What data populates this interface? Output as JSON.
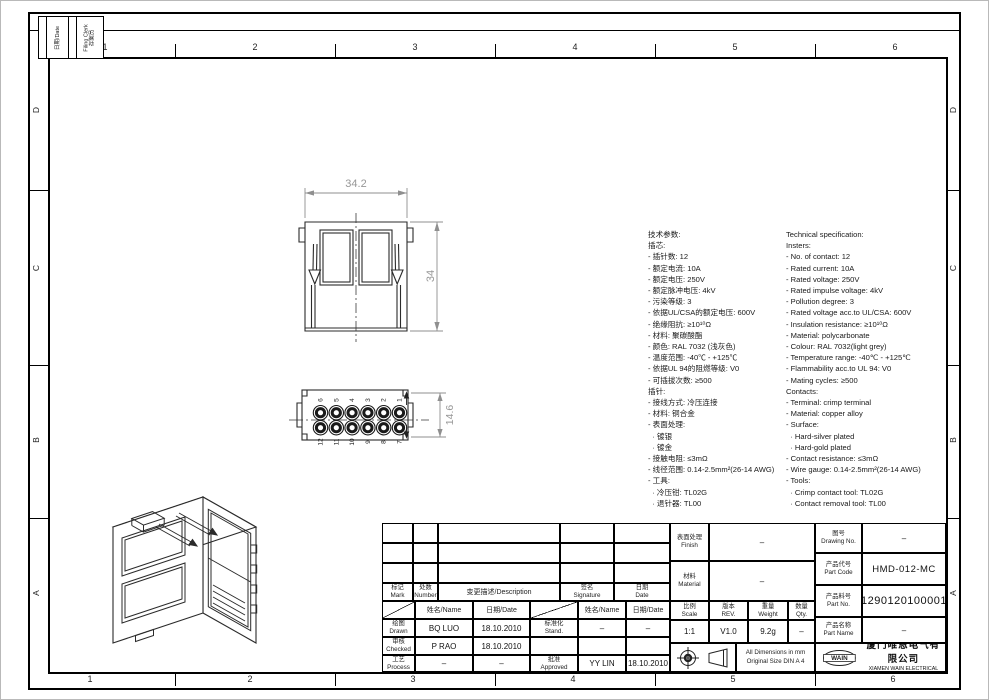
{
  "sheet": {
    "zones": {
      "top": [
        "1",
        "2",
        "3",
        "4",
        "5",
        "6"
      ],
      "bottom": [
        "1",
        "2",
        "3",
        "4",
        "5",
        "6"
      ],
      "left": [
        "D",
        "C",
        "B",
        "A"
      ],
      "right": [
        "D",
        "C",
        "B",
        "A"
      ]
    },
    "stamp": {
      "date_label": "日期/Date",
      "clerk_en": "Filing Clerk",
      "clerk_cn": "存案员"
    }
  },
  "views": {
    "front": {
      "dim_width": "34.2",
      "dim_height": "34"
    },
    "pinout": {
      "dim_height": "14.6",
      "pins_top": [
        "6",
        "5",
        "4",
        "3",
        "2",
        "1"
      ],
      "pins_bottom": [
        "12",
        "11",
        "10",
        "9",
        "8",
        "7"
      ]
    }
  },
  "specs": {
    "cn_lines": [
      "技术参数:",
      "插芯:",
      "- 插针数: 12",
      "- 额定电流: 10A",
      "- 额定电压: 250V",
      "- 额定脉冲电压: 4kV",
      "- 污染等级: 3",
      "- 依据UL/CSA的额定电压: 600V",
      "- 绝缘阻抗: ≥10¹⁰Ω",
      "- 材料: 聚碳酸酯",
      "- 颜色: RAL 7032 (浅灰色)",
      "- 温度范围: -40℃ - +125℃",
      "- 依据UL 94的阻燃等级: V0",
      "- 可插拔次数: ≥500",
      "插针:",
      "- 接线方式: 冷压连接",
      "- 材料: 铜合金",
      "- 表面处理:",
      "  · 镀银",
      "  · 镀金",
      "- 接触电阻: ≤3mΩ",
      "- 线径范围: 0.14-2.5mm²(26-14 AWG)",
      "- 工具:",
      "  · 冷压钳: TL02G",
      "  · 退针器: TL00"
    ],
    "en_lines": [
      "Technical specification:",
      "Insters:",
      "- No. of contact: 12",
      "- Rated current: 10A",
      "- Rated voltage: 250V",
      "- Rated impulse voltage: 4kV",
      "- Pollution degree: 3",
      "- Rated voltage acc.to UL/CSA: 600V",
      "- Insulation resistance: ≥10¹⁰Ω",
      "- Material: polycarbonate",
      "- Colour: RAL 7032(light grey)",
      "- Temperature range: -40℃ - +125℃",
      "- Flammability acc.to UL 94: V0",
      "- Mating cycles: ≥500",
      "Contacts:",
      "- Terminal: crimp terminal",
      "- Material: copper alloy",
      "- Surface:",
      "  · Hard-silver plated",
      "  · Hard-gold plated",
      "- Contact resistance: ≤3mΩ",
      "- Wire gauge: 0.14-2.5mm²(26-14 AWG)",
      "- Tools:",
      "  · Crimp contact tool: TL02G",
      "  · Contact removal tool: TL00"
    ]
  },
  "titleblock": {
    "rev": {
      "mark_cn": "标记",
      "mark_en": "Mark",
      "number_cn": "处数",
      "number_en": "Number",
      "description": "变更描述/Description",
      "sig_cn": "签名",
      "sig_en": "Signature",
      "date_cn": "日期",
      "date_en": "Date"
    },
    "sub": {
      "name_header": "姓名/Name",
      "date_header": "日期/Date",
      "drawn_cn": "绘图",
      "drawn_en": "Drawn",
      "drawn_name": "BQ LUO",
      "drawn_date": "18.10.2010",
      "checked_cn": "审核",
      "checked_en": "Checked",
      "checked_name": "P RAO",
      "checked_date": "18.10.2010",
      "process_cn": "工艺",
      "process_en": "Process",
      "process_name": "–",
      "process_date": "–",
      "stand_cn": "标准化",
      "stand_en": "Stand.",
      "stand_name": "–",
      "stand_date": "–",
      "approved_cn": "批准",
      "approved_en": "Approved",
      "approved_name": "YY LIN",
      "approved_date": "18.10.2010"
    },
    "props": {
      "finish_cn": "表面处理",
      "finish_en": "Finish",
      "finish_value": "–",
      "material_cn": "材料",
      "material_en": "Material",
      "material_value": "–",
      "scale_cn": "比例",
      "scale_en": "Scale",
      "scale_value": "1:1",
      "rev_cn": "版本",
      "rev_en": "REV.",
      "rev_value": "V1.0",
      "weight_cn": "重量",
      "weight_en": "Weight",
      "weight_value": "9.2g",
      "qty_cn": "数量",
      "qty_en": "Qty.",
      "qty_value": "–",
      "note_line1": "All Dimensions in mm",
      "note_line2": "Original Size DIN A 4"
    },
    "ident": {
      "dwg_cn": "图号",
      "dwg_en": "Drawing No.",
      "dwg_value": "–",
      "code_cn": "产品代号",
      "code_en": "Part Code",
      "code_value": "HMD-012-MC",
      "pn_cn": "产品料号",
      "pn_en": "Part No.",
      "pn_value": "1290120100001",
      "pname_cn": "产品名称",
      "pname_en": "Part Name",
      "pname_value": "–",
      "logo": "WAIN",
      "company_cn": "厦门唯恩电气有限公司",
      "company_en": "XIAMEN WAIN ELECTRICAL CO.LTD"
    }
  }
}
